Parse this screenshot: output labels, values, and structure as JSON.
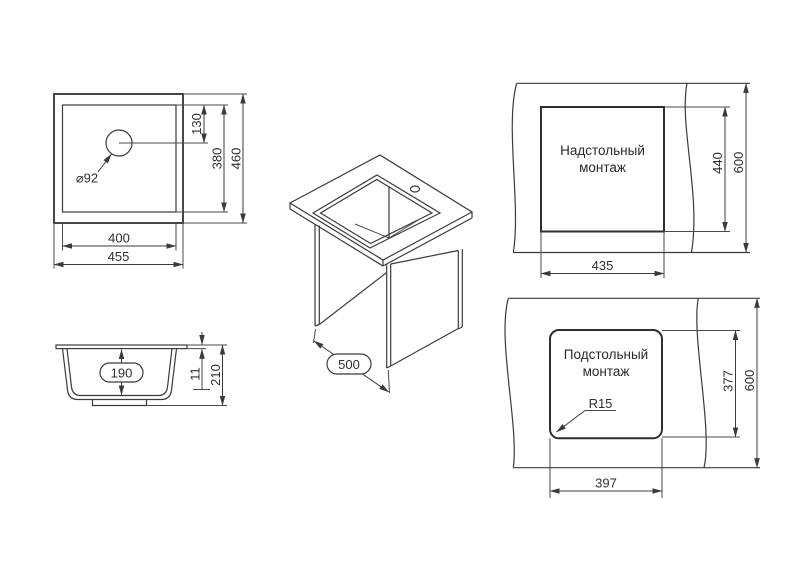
{
  "colors": {
    "line": "#3b3b3b",
    "text": "#2e2e2e",
    "background": "#ffffff"
  },
  "views": {
    "top_view": {
      "hole_diameter": "⌀92",
      "hole_center_offset": "130",
      "inner_depth": "380",
      "outer_depth": "460",
      "inner_width": "400",
      "outer_width": "455"
    },
    "section_view": {
      "bowl_depth": "190",
      "rim_height": "11",
      "overall_height": "210"
    },
    "iso_view": {
      "base_depth": "500"
    },
    "overmount_view": {
      "title_line1": "Надстольный",
      "title_line2": "монтаж",
      "cutout_height": "440",
      "counter_depth": "600",
      "cutout_width": "435"
    },
    "undermount_view": {
      "title_line1": "Подстольный",
      "title_line2": "монтаж",
      "corner_radius": "R15",
      "cutout_height": "377",
      "counter_depth": "600",
      "cutout_width": "397"
    }
  }
}
